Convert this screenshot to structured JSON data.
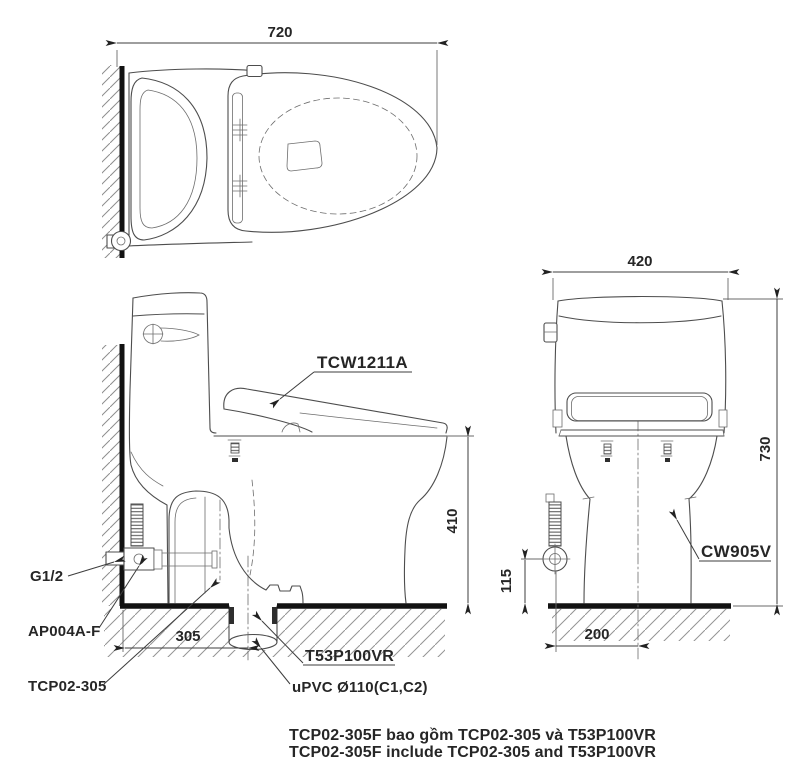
{
  "top_view": {
    "dim_width": "720"
  },
  "side_view": {
    "seat_label": "TCW1211A",
    "dim_rim_height": "410",
    "dim_rough_in": "305",
    "supply_thread_label": "G1/2",
    "stop_valve_label": "AP004A-F",
    "product_code_label": "TCP02-305",
    "flange_label": "T53P100VR",
    "drain_pipe_label": "uPVC Ø110(C1,C2)"
  },
  "front_view": {
    "dim_width": "420",
    "dim_height": "730",
    "dim_supply_height": "115",
    "dim_supply_offset": "200",
    "bowl_label": "CW905V"
  },
  "notes": {
    "vietnamese": "TCP02-305F bao gồm TCP02-305 và T53P100VR",
    "english": "TCP02-305F include TCP02-305 and T53P100VR"
  },
  "colors": {
    "line": "#4d4d4d",
    "heavy_line": "#121212",
    "text": "#262626",
    "background": "#ffffff"
  }
}
